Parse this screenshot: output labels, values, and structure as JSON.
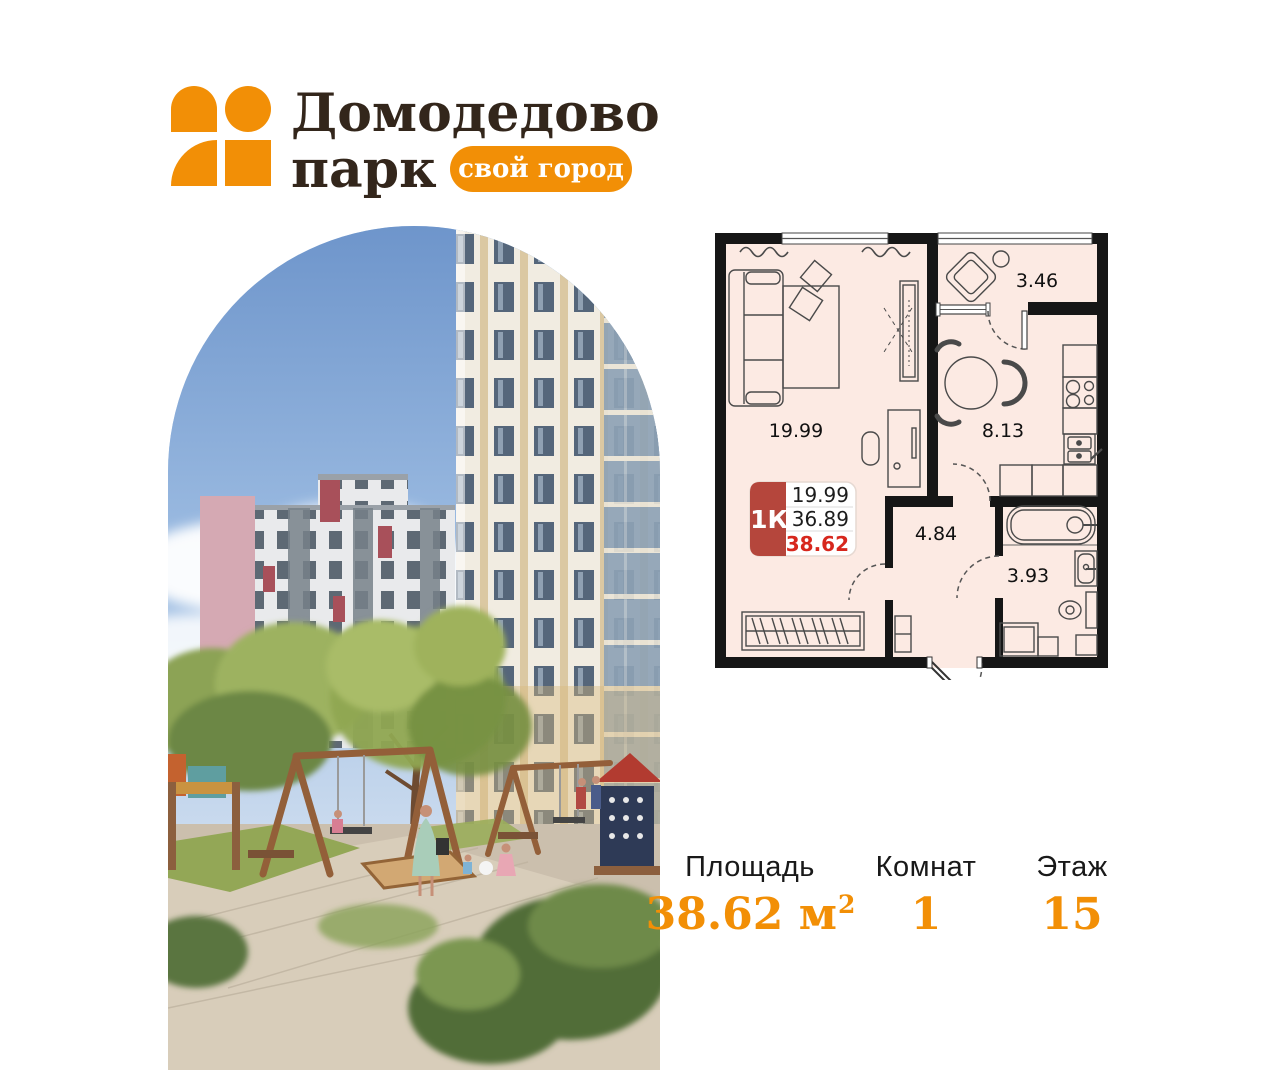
{
  "logo": {
    "line1": "Домодедово",
    "line2": "парк",
    "badge": "свой город"
  },
  "floor_plan": {
    "unit_badge": {
      "type": "1К",
      "living_area": "19.99",
      "area_without_balcony": "36.89",
      "total_area": "38.62"
    },
    "room_areas": {
      "living_room": "19.99",
      "kitchen": "8.13",
      "balcony": "3.46",
      "hallway": "4.84",
      "bathroom": "3.93"
    }
  },
  "stats": {
    "area": {
      "label": "Площадь",
      "value": "38.62 м",
      "sup": "2"
    },
    "rooms": {
      "label": "Комнат",
      "value": "1"
    },
    "floor": {
      "label": "Этаж",
      "value": "15"
    }
  },
  "colors": {
    "brand_orange": "#F28F06",
    "logo_text": "#33261B",
    "unit_badge_red": "#B5463C",
    "total_area_red": "#D7271D",
    "plan_room_fill": "#FCEAE3",
    "plan_wall": "#161616"
  }
}
